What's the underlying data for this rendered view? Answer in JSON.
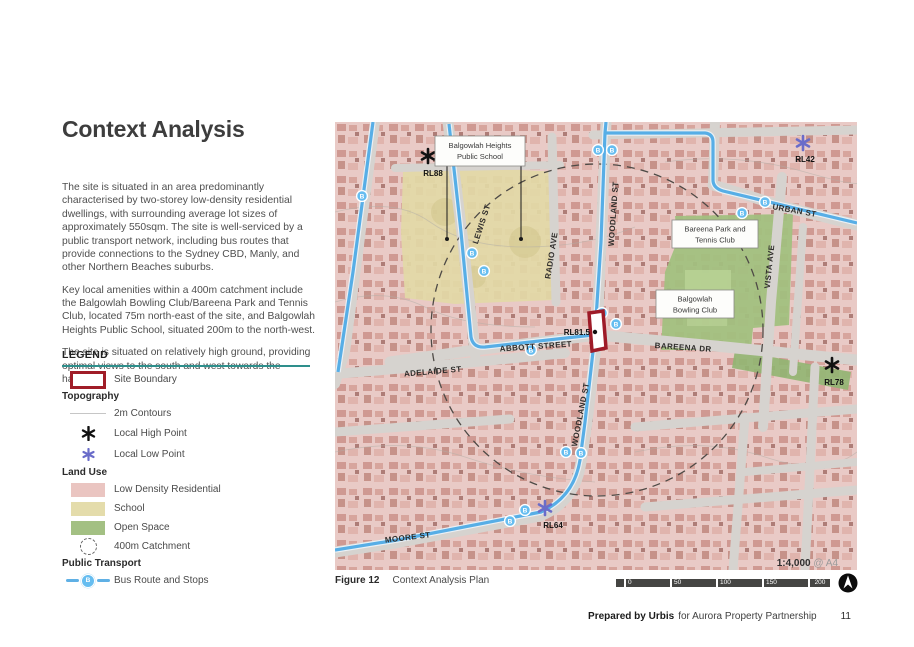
{
  "page_title": "Context Analysis",
  "paragraphs": {
    "p1": "The site is situated in an area predominantly characterised by two-storey low-density residential dwellings, with surrounding average lot sizes of approximately 550sqm. The site is well-serviced by a public transport network, including bus routes that provide connections to the Sydney CBD, Manly, and other Northern Beaches suburbs.",
    "p2": "Key local amenities within a 400m catchment include the Balgowlah Bowling Club/Bareena Park and Tennis Club, located 75m north-east of the site, and Balgowlah Heights Public School, situated 200m to the north-west.",
    "p3": "The site is situated on relatively high ground, providing optimal views to the south and west towards the harbour."
  },
  "legend": {
    "title": "LEGEND",
    "site_boundary": "Site Boundary",
    "topography_header": "Topography",
    "contours": "2m Contours",
    "high_point": "Local High Point",
    "low_point": "Local Low Point",
    "land_use_header": "Land Use",
    "residential": "Low Density Residential",
    "school": "School",
    "open_space": "Open Space",
    "catchment": "400m Catchment",
    "public_transport_header": "Public Transport",
    "bus": "Bus Route and Stops"
  },
  "map": {
    "bus_letter": "B",
    "streets": {
      "lewis": "LEWIS ST",
      "radio": "RADIO AVE",
      "woodland_top": "WOODLAND ST",
      "woodland_bottom": "WOODLAND ST",
      "urban": "URBAN ST",
      "vista": "VISTA AVE",
      "abbott": "ABBOTT STREET",
      "bareena": "BAREENA DR",
      "adelaide": "ADELAIDE ST",
      "moore": "MOORE ST"
    },
    "places": {
      "school_line1": "Balgowlah Heights",
      "school_line2": "Public School",
      "park_line1": "Bareena Park and",
      "park_line2": "Tennis Club",
      "bowling_line1": "Balgowlah",
      "bowling_line2": "Bowling Club"
    },
    "markers": {
      "rl88": "RL88",
      "rl42": "RL42",
      "rl78": "RL78",
      "rl64": "RL64",
      "rl815": "RL81.5"
    }
  },
  "figure": {
    "label": "Figure 12",
    "caption": "Context Analysis Plan"
  },
  "scalebar": {
    "ratio": "1:4,000",
    "sheet": "@ A4",
    "ticks": [
      "0",
      "50",
      "100",
      "150",
      "200"
    ]
  },
  "footer": {
    "bold": "Prepared by Urbis",
    "regular": "for Aurora Property Partnership",
    "page": "11"
  },
  "colors": {
    "accent_teal": "#2e8f8c",
    "site_boundary_red": "#a01d28",
    "bus_blue": "#5fb0e5",
    "residential_pink": "#eac5c1",
    "school_beige": "#e4dcab",
    "open_space_green": "#a3c083",
    "high_point_black": "#111111",
    "low_point_purple": "#6a6cc9"
  }
}
